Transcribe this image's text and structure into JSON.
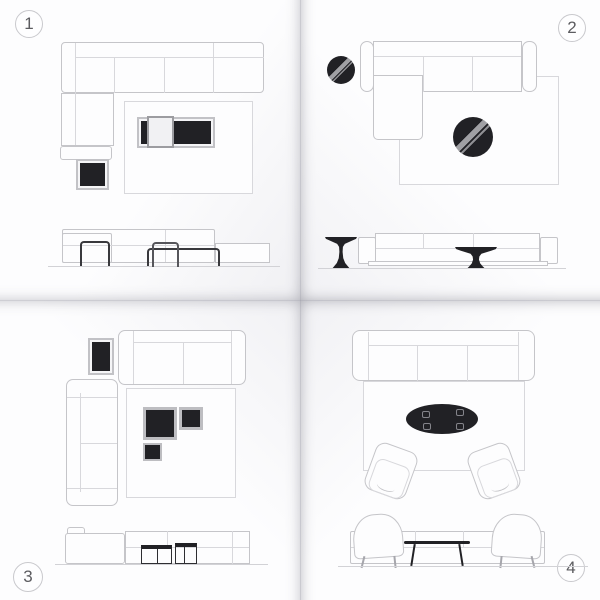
{
  "colors": {
    "ink": "#212125",
    "line": "#c5c5c9",
    "line_soft": "#d8d8dc",
    "wire": "#39393d",
    "stripe": "#a0a0a4",
    "stripe2": "#8f8f93",
    "number": "#5c5c60",
    "paper": "#fdfdfe",
    "ground": "#d2d2d6"
  },
  "panels": [
    {
      "badge": "1",
      "badge_corner": "top-left",
      "plan": {
        "items": [
          "corner-sectional-sofa",
          "area-rug",
          "two-tone-coffee-table",
          "black-cube-side-table"
        ]
      },
      "elevation": {
        "items": [
          "sectional-sofa-front",
          "wireframe-side-table",
          "wireframe-nesting-table",
          "wireframe-long-coffee-table"
        ]
      }
    },
    {
      "badge": "2",
      "badge_corner": "top-right",
      "plan": {
        "items": [
          "chaise-sofa",
          "area-rug",
          "round-pedestal-side-table",
          "round-pedestal-coffee-table"
        ]
      },
      "elevation": {
        "items": [
          "sofa-front",
          "pedestal-side-table",
          "pedestal-coffee-table"
        ]
      }
    },
    {
      "badge": "3",
      "badge_corner": "bottom-left",
      "plan": {
        "items": [
          "two-seat-sofa",
          "two-seat-sofa-rotated",
          "area-rug",
          "rectangular-side-table",
          "nesting-coffee-tables"
        ]
      },
      "elevation": {
        "items": [
          "two-sofas-front",
          "framed-cube-table-large",
          "framed-cube-table-small"
        ]
      }
    },
    {
      "badge": "4",
      "badge_corner": "bottom-right",
      "plan": {
        "items": [
          "three-seat-sofa",
          "area-rug",
          "oval-coffee-table",
          "armchair",
          "armchair"
        ]
      },
      "elevation": {
        "items": [
          "sofa-back",
          "armchair",
          "armchair",
          "slim-coffee-table"
        ]
      }
    }
  ]
}
